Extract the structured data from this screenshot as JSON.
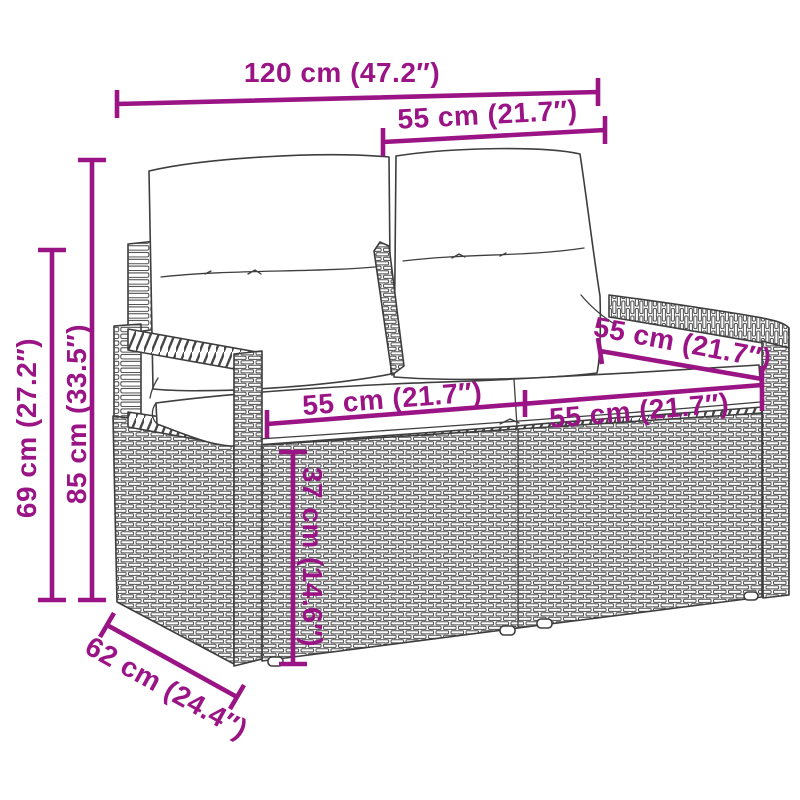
{
  "page": {
    "background": "#ffffff"
  },
  "illustration": {
    "subject": "rattan-two-seater-garden-sofa-with-cushions",
    "line_color": "#3e3e3e",
    "accent_color": "#9a1486"
  },
  "dims": {
    "total_width": "120 cm (47.2″)",
    "back_section_width": "55 cm (21.7″)",
    "total_height": "85 cm (33.5″)",
    "arm_height": "69 cm (27.2″)",
    "seat_width_left": "55 cm (21.7″)",
    "seat_width_right": "55 cm (21.7″)",
    "seat_depth": "55 cm (21.7″)",
    "seat_height": "37 cm (14.6″)",
    "total_depth": "62 cm (24.4″)"
  }
}
